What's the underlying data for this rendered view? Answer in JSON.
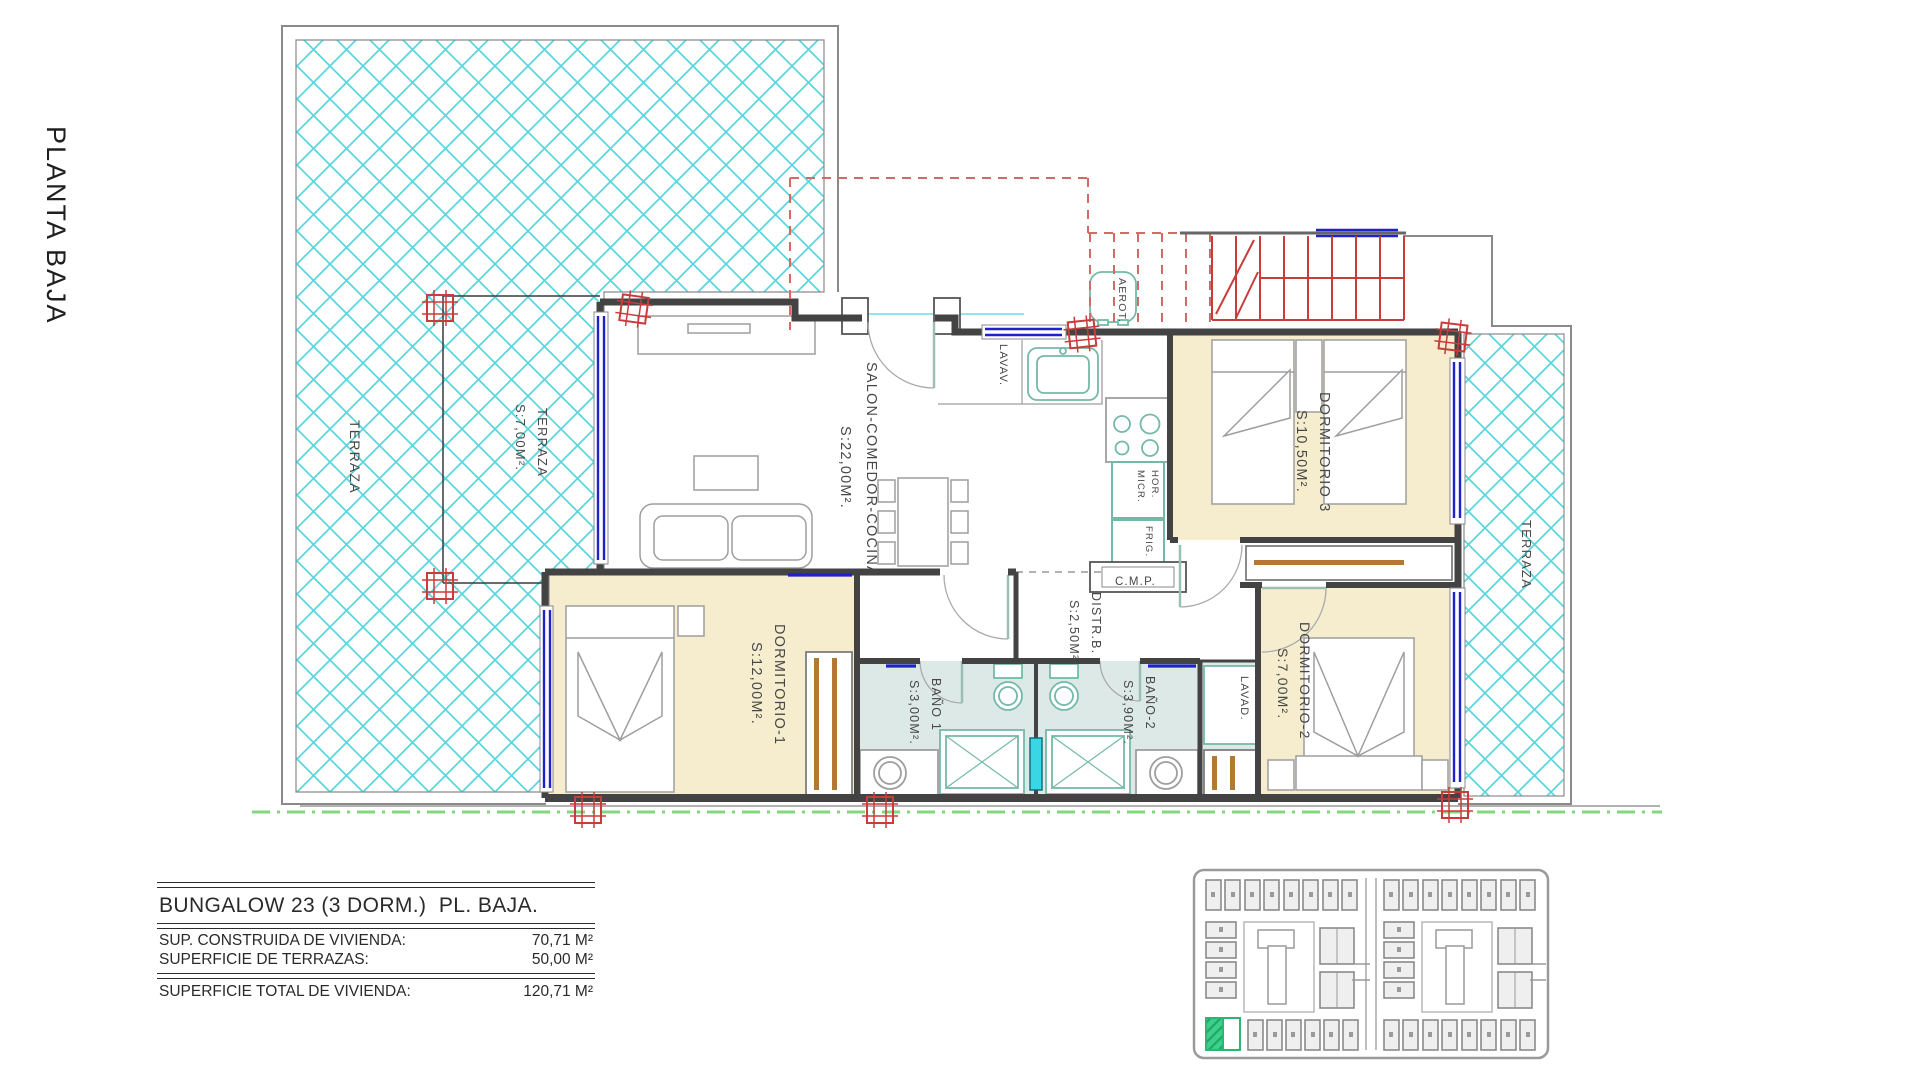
{
  "page": {
    "sheet_title": "PLANTA BAJA"
  },
  "labels": {
    "terraza_left": "TERRAZA",
    "terraza_small_1": "TERRAZA",
    "terraza_small_2": "S:7,00M².",
    "salon_1": "SALON-COMEDOR-COCINA",
    "salon_2": "S:22,00M².",
    "dorm3_1": "DORMITORIO 3",
    "dorm3_2": "S:10,50M².",
    "terraza_right": "TERRAZA",
    "dorm1_1": "DORMITORIO-1",
    "dorm1_2": "S:12,00M².",
    "distr_1": "DISTR.B.",
    "distr_2": "S:2,50M².",
    "bano1_1": "BAÑO 1",
    "bano1_2": "S:3,00M².",
    "bano2_1": "BAÑO-2",
    "bano2_2": "S:3,90M².",
    "dorm2_1": "DORMITORIO-2",
    "dorm2_2": "S:7,00M².",
    "lavad": "LAVAD.",
    "lavav": "LAVAV.",
    "aerot": "AEROT.",
    "cmp": "C.M.P.",
    "hor": "HOR.",
    "micr": "MICR.",
    "frig": "FRIG."
  },
  "info_table": {
    "title": "BUNGALOW 23 (3 DORM.)  PL. BAJA.",
    "rows": [
      {
        "label": "SUP. CONSTRUIDA DE VIVIENDA:",
        "value": "70,71 M²"
      },
      {
        "label": "SUPERFICIE DE TERRAZAS:",
        "value": "50,00 M²"
      }
    ],
    "total_row": {
      "label": "SUPERFICIE TOTAL DE VIVIENDA:",
      "value": "120,71 M²"
    }
  },
  "site_plan": {
    "highlighted_unit": "Bungalow 23",
    "highlight_color": "#3ecf8c"
  },
  "colors": {
    "terrace_hatch": "#58d6de",
    "window_blue": "#2121c9",
    "structure_red": "#c83c3c",
    "overhead_dashed_red": "#d46a63",
    "property_line_green": "#82d87c",
    "bedroom_floor": "#f5edcd",
    "bathroom_floor": "#dde9e6",
    "fixture_teal": "#74b9a8",
    "wardrobe_brown": "#b07a35"
  }
}
